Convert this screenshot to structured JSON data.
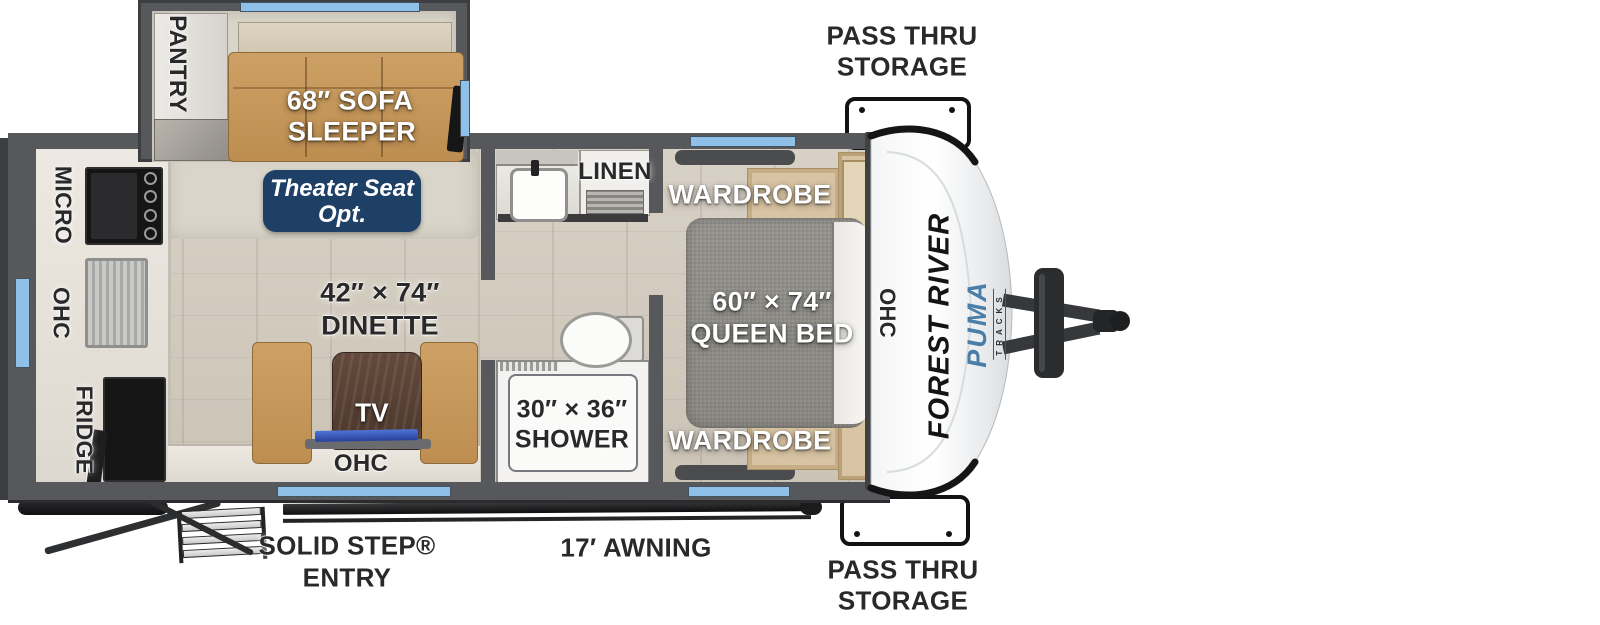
{
  "colors": {
    "window_blue": "#8fc0e8",
    "badge_navy": "#1e3f66",
    "brand_blue": "#4a7ea8",
    "wall_gray": "#57585c",
    "sofa_tan": "#c69a5e"
  },
  "exterior": {
    "pass_thru_top_line1": "PASS THRU",
    "pass_thru_top_line2": "STORAGE",
    "pass_thru_bottom_line1": "PASS THRU",
    "pass_thru_bottom_line2": "STORAGE",
    "entry_line1": "SOLID STEP®",
    "entry_line2": "ENTRY",
    "awning": "17′ AWNING"
  },
  "front_cap": {
    "brand": "FOREST RIVER",
    "model": "PUMA",
    "model_sub": "TRACKS"
  },
  "slide_out": {
    "pantry": "PANTRY",
    "sofa_line1": "68″ SOFA",
    "sofa_line2": "SLEEPER",
    "theater_line1": "Theater Seat",
    "theater_line2": "Opt."
  },
  "kitchen": {
    "micro": "MICRO",
    "ohc": "OHC",
    "fridge": "FRIDGE"
  },
  "living": {
    "dinette_line1": "42″ × 74″",
    "dinette_line2": "DINETTE",
    "tv": "TV",
    "ohc": "OHC"
  },
  "bathroom": {
    "linen": "LINEN",
    "shower_line1": "30″ × 36″",
    "shower_line2": "SHOWER"
  },
  "bedroom": {
    "wardrobe_top": "WARDROBE",
    "wardrobe_bottom": "WARDROBE",
    "bed_line1": "60″ × 74″",
    "bed_line2": "QUEEN BED",
    "ohc": "OHC"
  }
}
